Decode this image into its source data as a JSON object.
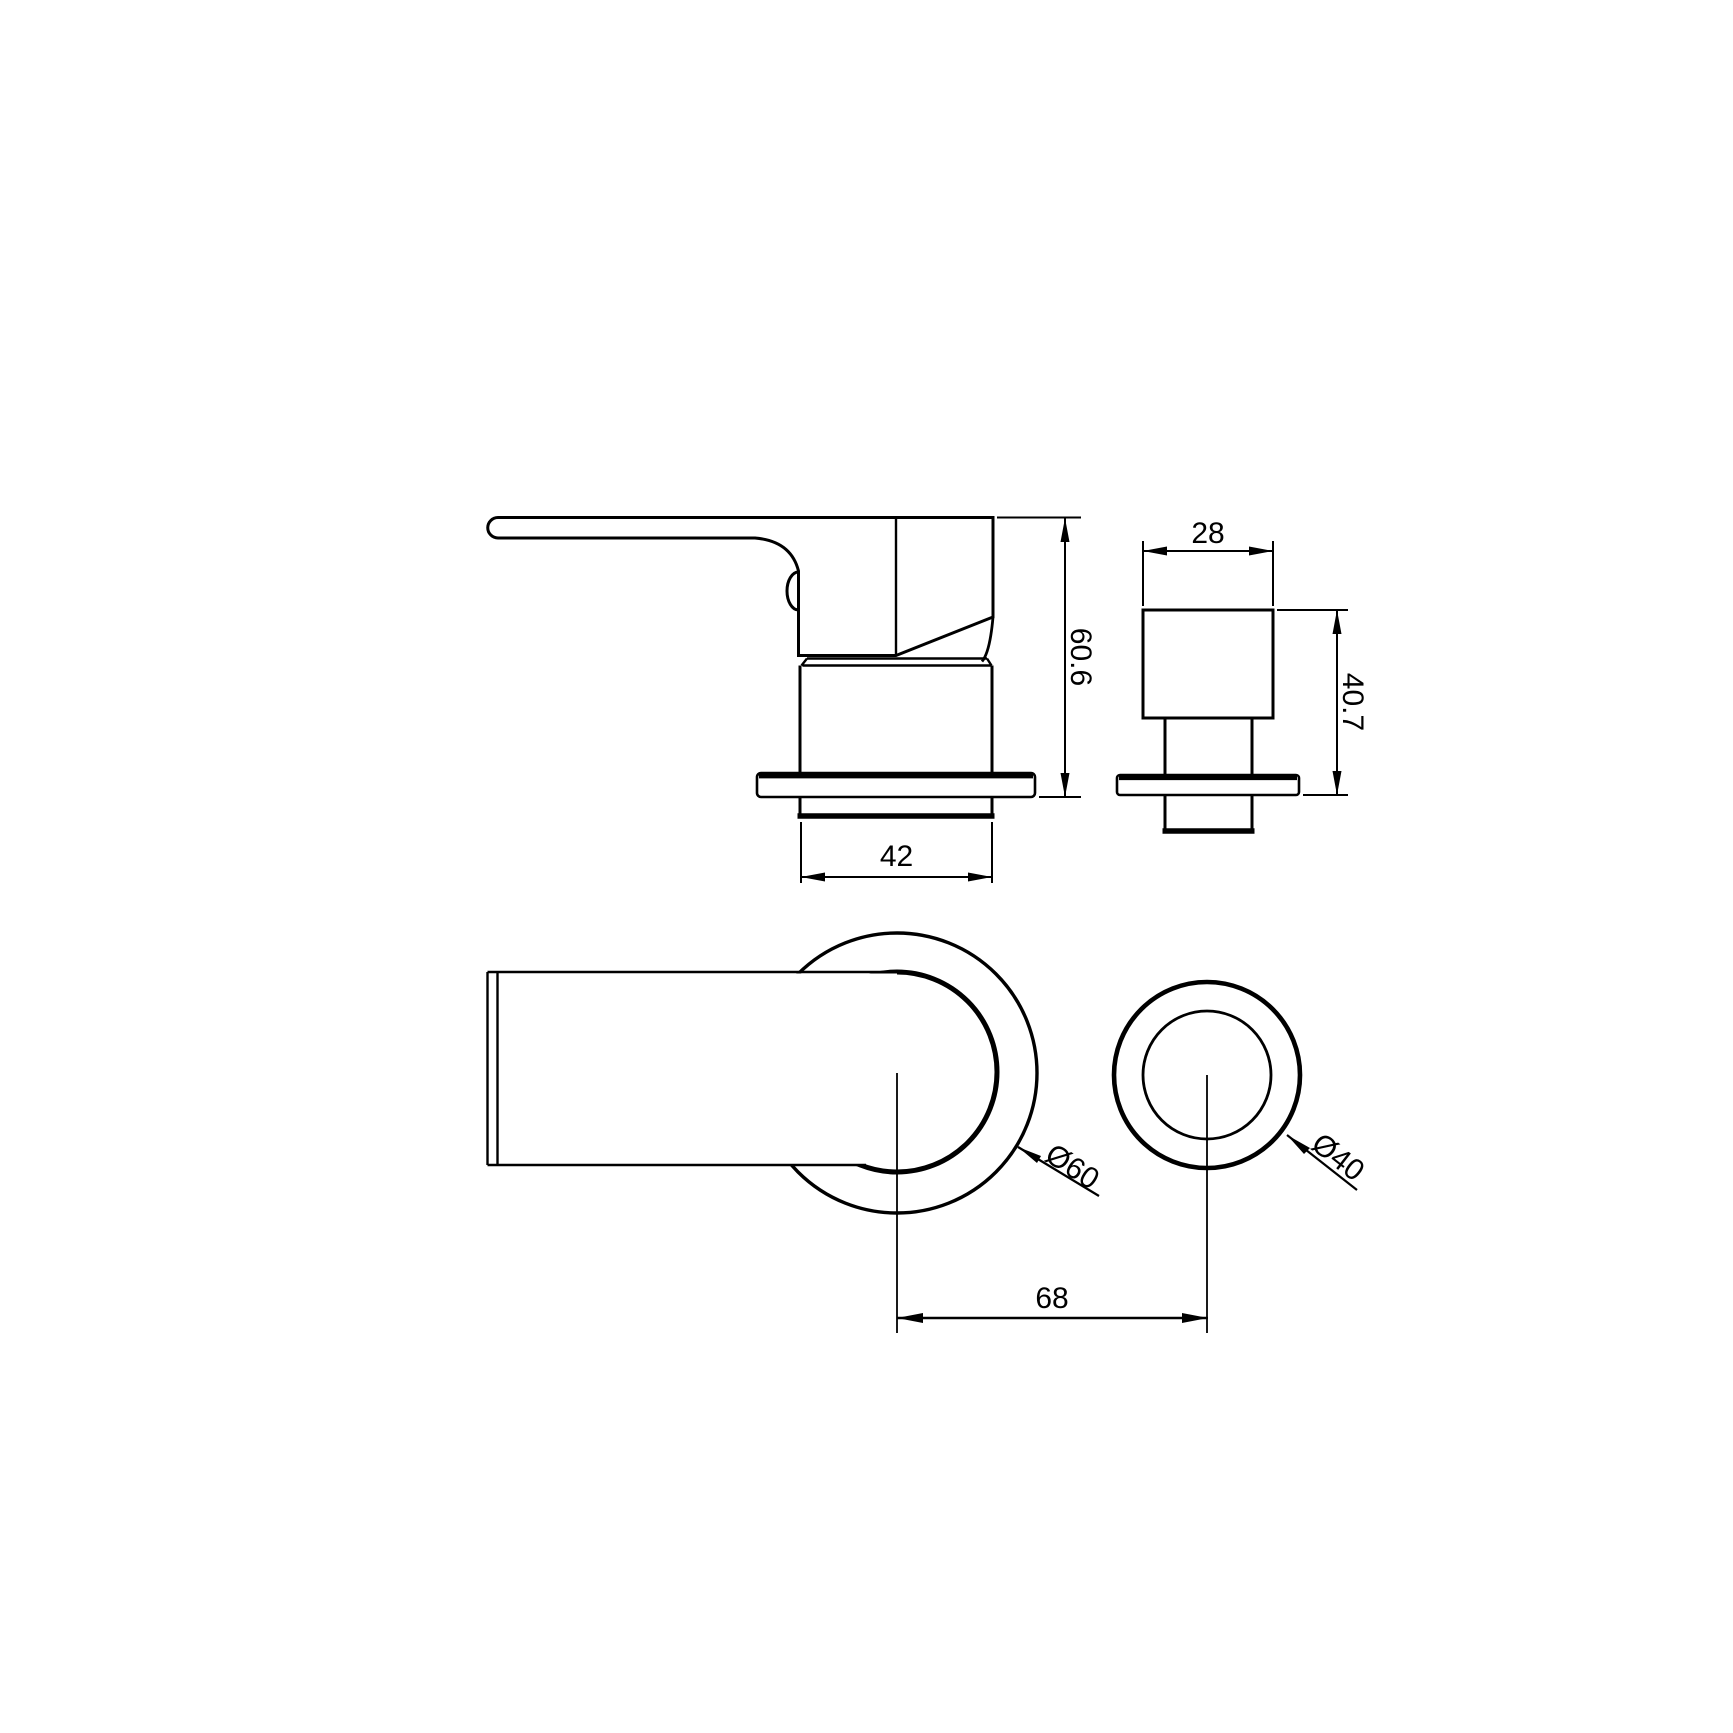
{
  "drawing": {
    "type": "technical-drawing",
    "views": {
      "side_view_mixer": "mixer tap side view",
      "side_view_valve": "valve knob side view",
      "top_view_mixer": "mixer tap top view",
      "top_view_valve": "valve knob top view"
    },
    "dimensions": {
      "mixer_height": "60.6",
      "mixer_body_width": "42",
      "valve_knob_width": "28",
      "valve_height": "40.7",
      "mixer_escutcheon_diameter": "Ø60",
      "valve_escutcheon_diameter": "Ø40",
      "center_distance": "68"
    },
    "colors": {
      "line": "#000000",
      "background": "#ffffff"
    }
  }
}
